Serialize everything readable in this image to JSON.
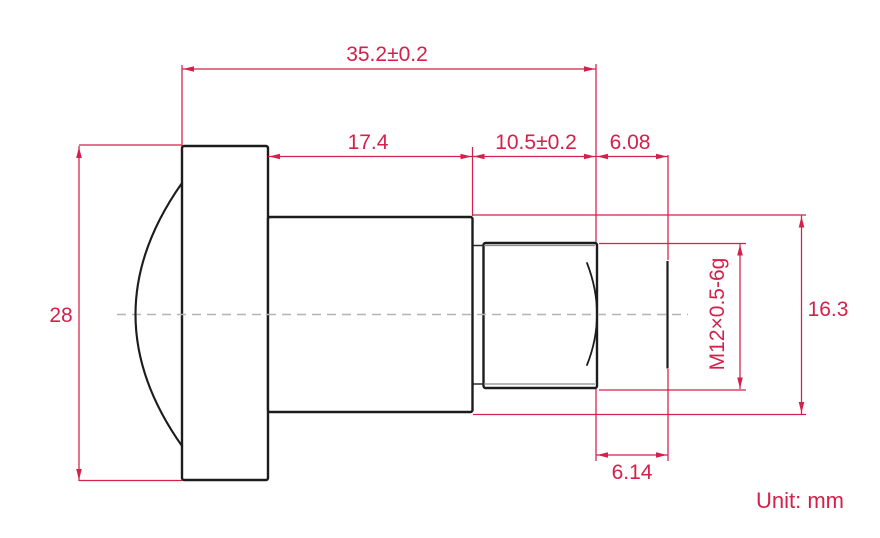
{
  "drawing": {
    "unit_note": "Unit: mm",
    "dims": {
      "overall_length": "35.2±0.2",
      "body_length": "17.4",
      "thread_length": "10.5±0.2",
      "rear_clearance": "6.08",
      "front_diameter": "28",
      "barrel_diameter": "16.3",
      "thread_spec": "M12×0.5-6g",
      "rear_length": "6.14"
    },
    "colors": {
      "dimension_red": "#d4204a",
      "outline_black": "#1c1c1c",
      "centerline_gray": "#b5b5b5"
    }
  }
}
